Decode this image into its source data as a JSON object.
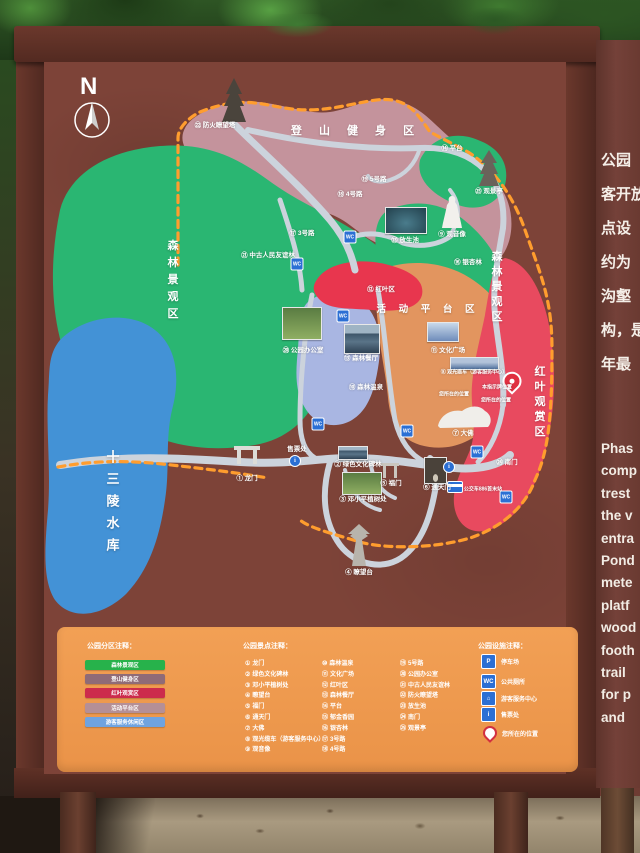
{
  "scene": {
    "compass": "N"
  },
  "colors": {
    "board_maroon": "#7d4338",
    "frame_brown": "#5e2f26",
    "zone_forest_green": "#2ab672",
    "zone_hiking_pink": "#c4939c",
    "zone_redleaf_red": "#e84a5f",
    "zone_redleaf_patch": "#e8364e",
    "zone_platform_salmon": "#e2955f",
    "zone_service_periwinkle": "#a9b6e2",
    "reservoir_blue": "#4392d6",
    "road_gray": "#ccd3dc",
    "boundary_orange": "#ff9d2e",
    "legend_bg_orange": "#ef9a4e",
    "info_panel_brown": "#6e3c33",
    "facility_icon_blue": "#2b6fd4",
    "you_are_here_red": "#e03040"
  },
  "map": {
    "zone_labels": [
      {
        "t": "登 山 健 身 区",
        "x": 356,
        "y": 130,
        "cls": "zh"
      },
      {
        "t": "活 动 平 台 区",
        "x": 428,
        "y": 308,
        "cls": "zh2"
      },
      {
        "t": "森林景观区",
        "x": 172,
        "y": 282,
        "cls": "zv"
      },
      {
        "t": "森林景观区",
        "x": 496,
        "y": 288,
        "cls": "zv2"
      },
      {
        "t": "红叶观赏区",
        "x": 539,
        "y": 403,
        "cls": "zv2"
      },
      {
        "t": "十三陵水库",
        "x": 112,
        "y": 505,
        "cls": "zw"
      }
    ],
    "point_labels": [
      {
        "x": 215,
        "y": 124,
        "t": "㉒ 防火瞭望塔"
      },
      {
        "x": 452,
        "y": 147,
        "t": "⑭ 平台"
      },
      {
        "x": 489,
        "y": 190,
        "t": "㉕ 观景亭"
      },
      {
        "x": 374,
        "y": 178,
        "t": "⑲ 5号路"
      },
      {
        "x": 350,
        "y": 193,
        "t": "⑱ 4号路"
      },
      {
        "x": 302,
        "y": 232,
        "t": "⑰ 3号路"
      },
      {
        "x": 405,
        "y": 239,
        "t": "㉓ 放生池"
      },
      {
        "x": 452,
        "y": 233,
        "t": "⑨ 观音像"
      },
      {
        "x": 468,
        "y": 261,
        "t": "⑯ 银杏林"
      },
      {
        "x": 268,
        "y": 254,
        "t": "㉑ 中古人民友谊林"
      },
      {
        "x": 303,
        "y": 349,
        "t": "⑳ 公园办公室"
      },
      {
        "x": 381,
        "y": 288,
        "t": "⑫ 红叶区"
      },
      {
        "x": 361,
        "y": 357,
        "t": "⑬ 森林餐厅"
      },
      {
        "x": 448,
        "y": 349,
        "t": "⑪ 文化广场"
      },
      {
        "x": 366,
        "y": 386,
        "t": "⑩ 森林温泉"
      },
      {
        "x": 474,
        "y": 372,
        "t": "⑧ 观光缆车（游客服务中心）",
        "cls": "tiny"
      },
      {
        "x": 454,
        "y": 394,
        "t": "您所在的位置",
        "cls": "tiny"
      },
      {
        "x": 497,
        "y": 387,
        "t": "本指示牌位置",
        "cls": "tiny"
      },
      {
        "x": 496,
        "y": 400,
        "t": "您所在的位置",
        "cls": "tiny"
      },
      {
        "x": 463,
        "y": 432,
        "t": "⑦ 大佛"
      },
      {
        "x": 507,
        "y": 461,
        "t": "㉔ 南门"
      },
      {
        "x": 437,
        "y": 486,
        "t": "⑥ 通天门"
      },
      {
        "x": 483,
        "y": 489,
        "t": "公交车886首末站",
        "cls": "tiny"
      },
      {
        "x": 391,
        "y": 482,
        "t": "⑤ 福门"
      },
      {
        "x": 363,
        "y": 498,
        "t": "③ 邓小平植树处"
      },
      {
        "x": 358,
        "y": 463,
        "t": "② 绿色文化碑林"
      },
      {
        "x": 247,
        "y": 477,
        "t": "① 龙门"
      },
      {
        "x": 297,
        "y": 448,
        "t": "售票处"
      },
      {
        "x": 359,
        "y": 571,
        "t": "④ 瞭望台"
      }
    ],
    "photos": [
      {
        "x": 385,
        "y": 207,
        "w": 40,
        "h": 25,
        "g": "pond"
      },
      {
        "x": 282,
        "y": 307,
        "w": 38,
        "h": 31,
        "g": "trees"
      },
      {
        "x": 344,
        "y": 324,
        "w": 34,
        "h": 28,
        "g": "bldg"
      },
      {
        "x": 427,
        "y": 322,
        "w": 30,
        "h": 18,
        "g": "plaza"
      },
      {
        "x": 450,
        "y": 357,
        "w": 47,
        "h": 11,
        "g": "bridge"
      },
      {
        "x": 338,
        "y": 446,
        "w": 28,
        "h": 12,
        "g": "bldg"
      },
      {
        "x": 342,
        "y": 472,
        "w": 38,
        "h": 21,
        "g": "trees"
      },
      {
        "x": 424,
        "y": 457,
        "w": 21,
        "h": 25,
        "g": "arch"
      }
    ],
    "icons": [
      {
        "k": "wc",
        "g": "WC",
        "x": 350,
        "y": 237
      },
      {
        "k": "wc",
        "g": "WC",
        "x": 297,
        "y": 264
      },
      {
        "k": "wc",
        "g": "WC",
        "x": 343,
        "y": 316
      },
      {
        "k": "wc",
        "g": "WC",
        "x": 318,
        "y": 424
      },
      {
        "k": "wc",
        "g": "WC",
        "x": 407,
        "y": 431
      },
      {
        "k": "wc",
        "g": "WC",
        "x": 477,
        "y": 452
      },
      {
        "k": "wc",
        "g": "WC",
        "x": 506,
        "y": 497
      },
      {
        "k": "info",
        "g": "i",
        "x": 295,
        "y": 461
      },
      {
        "k": "info",
        "g": "i",
        "x": 449,
        "y": 467
      },
      {
        "k": "bus",
        "g": "",
        "x": 455,
        "y": 487
      },
      {
        "k": "pin",
        "g": "",
        "x": 512,
        "y": 385
      }
    ]
  },
  "legend_zones": {
    "title": "公园分区注释：",
    "items": [
      {
        "label": "森林景观区",
        "color": "#27b24b"
      },
      {
        "label": "登山健身区",
        "color": "#8f6b77"
      },
      {
        "label": "红叶观赏区",
        "color": "#cc2b4c"
      },
      {
        "label": "活动平台区",
        "color": "#b58f96"
      },
      {
        "label": "游客服务休闲区",
        "color": "#6fa3e0"
      }
    ]
  },
  "legend_spots": {
    "title": "公园景点注释：",
    "col1": [
      {
        "num": "①",
        "label": "龙门"
      },
      {
        "num": "②",
        "label": "绿色文化碑林"
      },
      {
        "num": "③",
        "label": "邓小平植树处"
      },
      {
        "num": "④",
        "label": "瞭望台"
      },
      {
        "num": "⑤",
        "label": "福门"
      },
      {
        "num": "⑥",
        "label": "通天门"
      },
      {
        "num": "⑦",
        "label": "大佛"
      },
      {
        "num": "⑧",
        "label": "观光缆车（游客服务中心）"
      },
      {
        "num": "⑨",
        "label": "观音像"
      }
    ],
    "col2": [
      {
        "num": "⑩",
        "label": "森林温泉"
      },
      {
        "num": "⑪",
        "label": "文化广场"
      },
      {
        "num": "⑫",
        "label": "红叶区"
      },
      {
        "num": "⑬",
        "label": "森林餐厅"
      },
      {
        "num": "⑭",
        "label": "平台"
      },
      {
        "num": "⑮",
        "label": "郁金香园"
      },
      {
        "num": "⑯",
        "label": "银杏林"
      },
      {
        "num": "⑰",
        "label": "3号路"
      },
      {
        "num": "⑱",
        "label": "4号路"
      }
    ],
    "col3": [
      {
        "num": "⑲",
        "label": "5号路"
      },
      {
        "num": "⑳",
        "label": "公园办公室"
      },
      {
        "num": "㉑",
        "label": "中古人民友谊林"
      },
      {
        "num": "㉒",
        "label": "防火瞭望塔"
      },
      {
        "num": "㉓",
        "label": "放生池"
      },
      {
        "num": "㉔",
        "label": "南门"
      },
      {
        "num": "㉕",
        "label": "观景亭"
      }
    ]
  },
  "legend_facilities": {
    "title": "公园设施注释：",
    "items": [
      {
        "glyph": "P",
        "cls": "sq",
        "label": "停车场"
      },
      {
        "glyph": "WC",
        "cls": "sq",
        "label": "公共厕所"
      },
      {
        "glyph": "⌂",
        "cls": "sq",
        "label": "游客服务中心"
      },
      {
        "glyph": "i",
        "cls": "sq",
        "label": "售票处"
      },
      {
        "glyph": "",
        "cls": "pin",
        "label": "您所在的位置"
      }
    ]
  },
  "side_panel": {
    "chinese_lines": [
      "公园",
      "客开放",
      "点设",
      "约为",
      "沟壑",
      "构，是",
      "年最"
    ],
    "english_lines": [
      "Phas",
      "comp",
      "trest",
      "the v",
      "entra",
      "Pond",
      "mete",
      "platf",
      "wood",
      "footh",
      "trail",
      "for p",
      "and"
    ]
  }
}
